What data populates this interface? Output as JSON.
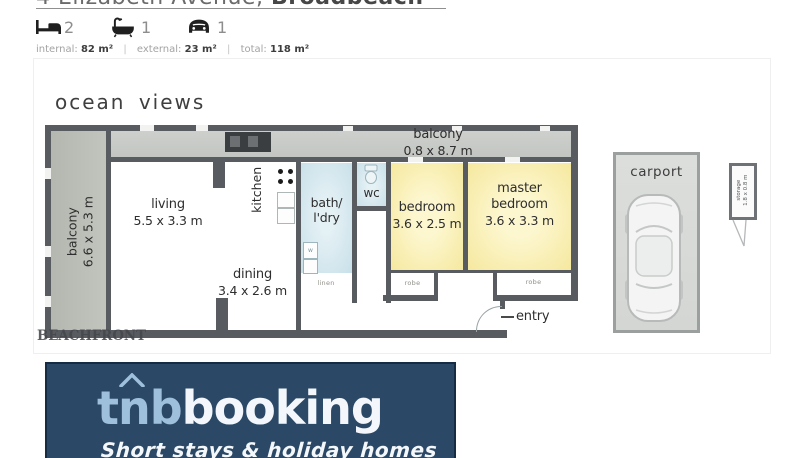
{
  "header": {
    "title_street": "4 Elizabeth Avenue, ",
    "title_suburb": "Broadbeach",
    "beds": "2",
    "baths": "1",
    "cars": "1",
    "areas": {
      "internal_label": "internal:",
      "internal_value": "82 m²",
      "external_label": "external:",
      "external_value": "23 m²",
      "total_label": "total:",
      "total_value": "118 m²",
      "divider": "|"
    }
  },
  "floorplan": {
    "ocean_views": "ocean views",
    "watermark": "BEACHFRONT",
    "balcony_left": {
      "name": "balcony",
      "dims": "6.6 x 5.3 m"
    },
    "balcony_top": {
      "name": "balcony",
      "dims": "0.8 x 8.7 m"
    },
    "living": {
      "name": "living",
      "dims": "5.5 x 3.3 m"
    },
    "dining": {
      "name": "dining",
      "dims": "3.4 x 2.6 m"
    },
    "kitchen": {
      "name": "kitchen"
    },
    "bath": {
      "line1": "bath/",
      "line2": "l'dry"
    },
    "wc": {
      "name": "wc"
    },
    "linen": {
      "name": "linen"
    },
    "washer": {
      "label": "w"
    },
    "bedroom": {
      "name": "bedroom",
      "dims": "3.6 x 2.5 m"
    },
    "master": {
      "line1": "master",
      "line2": "bedroom",
      "dims": "3.6 x 3.3 m"
    },
    "robe_left": {
      "name": "robe"
    },
    "robe_right": {
      "name": "robe"
    },
    "entry": {
      "name": "entry"
    },
    "carport": {
      "name": "carport"
    },
    "storage": {
      "line1": "storage",
      "line2": "1.8 x 0.8 m"
    }
  },
  "footer": {
    "brand_prefix": "tnb",
    "brand_suffix": "booking",
    "tagline": "Short stays & holiday homes"
  },
  "colors": {
    "wall": "#585c61",
    "balcony_fill": "#b9bdb5",
    "bedroom_fill": "#f5e89e",
    "wet_area_fill": "#cde3ea",
    "carport_fill": "#d8dad8",
    "footer_bg": "#2b4967",
    "brand_light_blue": "#9fc0dc"
  }
}
